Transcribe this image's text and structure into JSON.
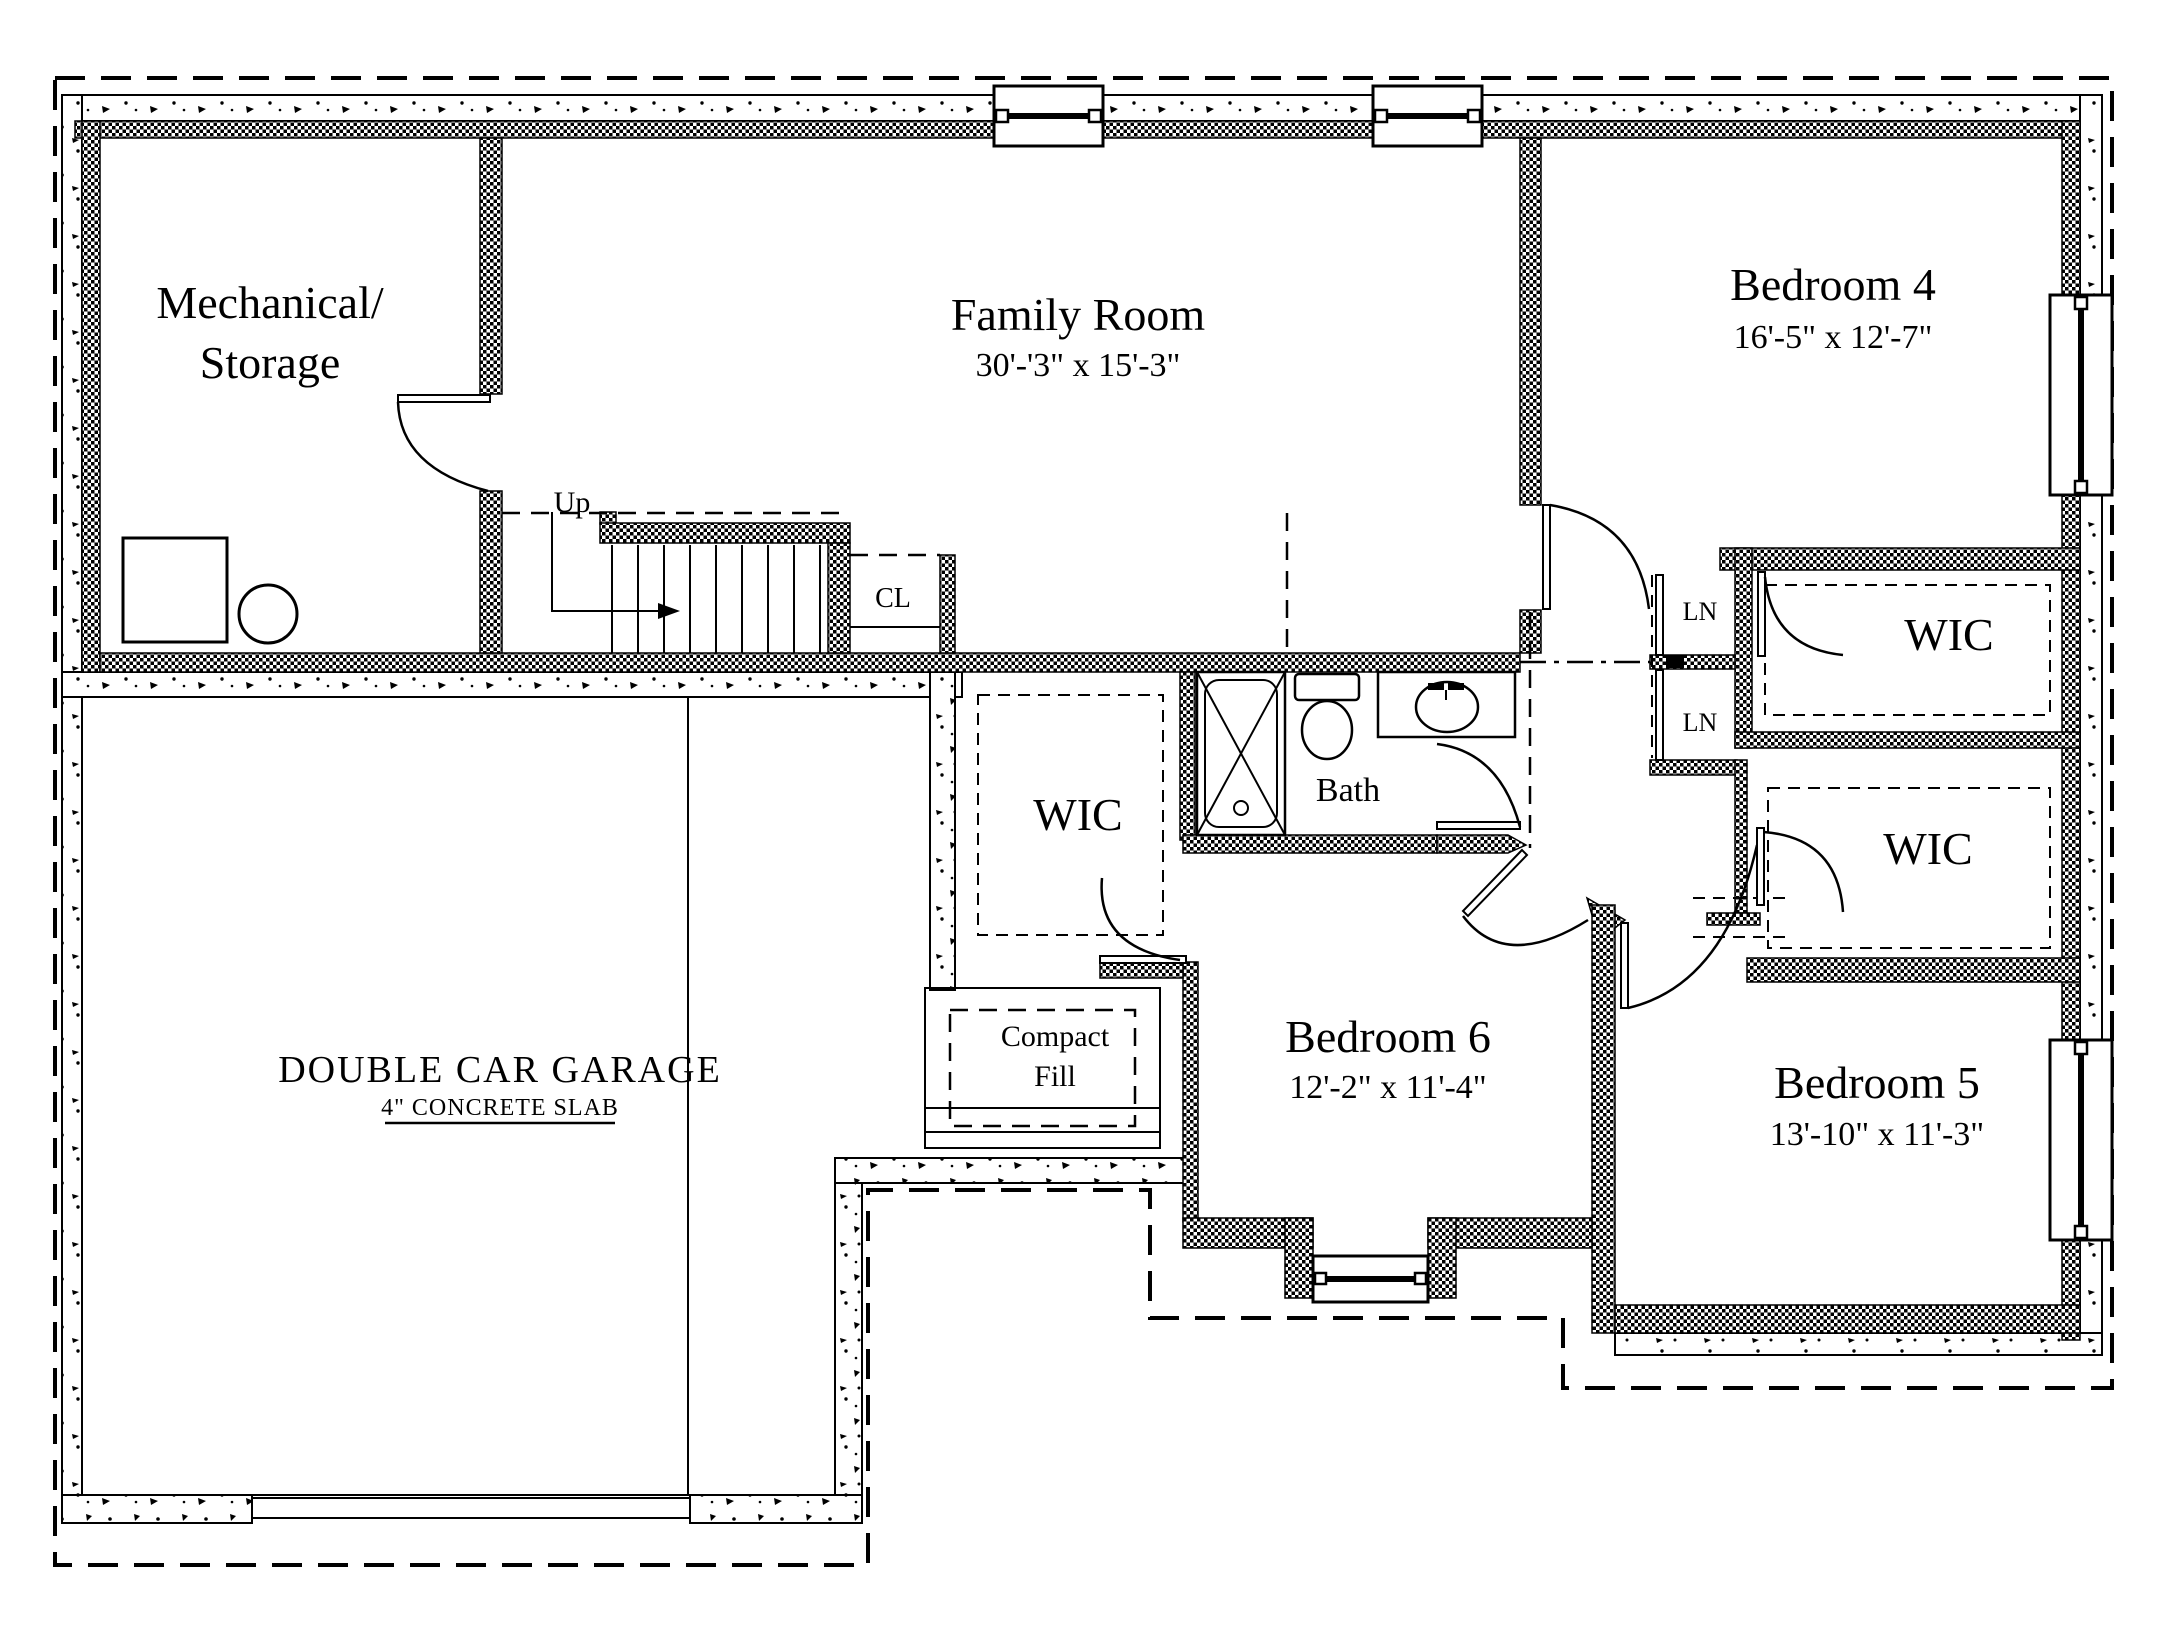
{
  "plan": {
    "type": "basement-floor-plan",
    "ink_color": "#000000",
    "paper_color": "#ffffff",
    "rooms": {
      "mechanical": {
        "label_line1": "Mechanical/",
        "label_line2": "Storage"
      },
      "family": {
        "label": "Family Room",
        "dims": "30'-'3\" x 15'-3\""
      },
      "bedroom4": {
        "label": "Bedroom 4",
        "dims": "16'-5\" x 12'-7\""
      },
      "bedroom5": {
        "label": "Bedroom 5",
        "dims": "13'-10\" x 11'-3\""
      },
      "bedroom6": {
        "label": "Bedroom 6",
        "dims": "12'-2\" x 11'-4\""
      },
      "bath": {
        "label": "Bath"
      },
      "wic_left": {
        "label": "WIC"
      },
      "wic_top_right": {
        "label": "WIC"
      },
      "wic_bottom_right": {
        "label": "WIC"
      },
      "closet": {
        "label": "CL"
      },
      "linen1": {
        "label": "LN"
      },
      "linen2": {
        "label": "LN"
      },
      "garage": {
        "label": "DOUBLE CAR GARAGE",
        "slab_note": "4\" CONCRETE SLAB"
      },
      "compact_fill": {
        "label_line1": "Compact",
        "label_line2": "Fill"
      },
      "stairs": {
        "direction_label": "Up"
      }
    }
  }
}
